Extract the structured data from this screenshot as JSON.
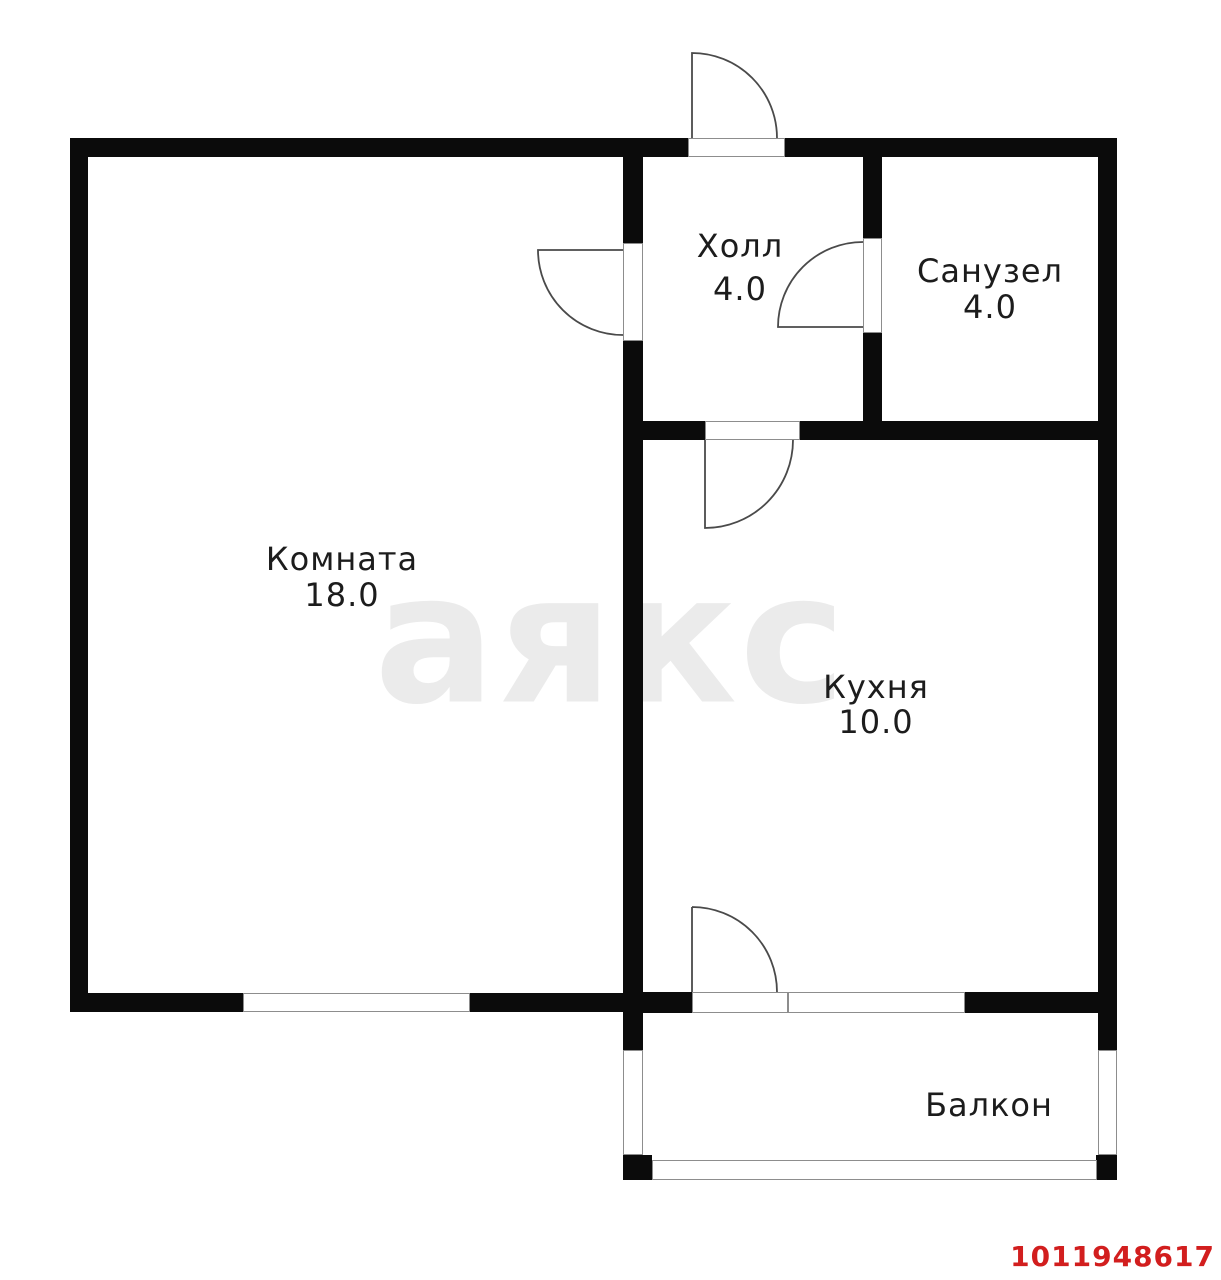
{
  "plan": {
    "watermark": "аякс",
    "listing_id": "1011948617",
    "rooms": {
      "hall": {
        "label": "Холл",
        "area": "4.0"
      },
      "bathroom": {
        "label": "Санузел",
        "area": "4.0"
      },
      "living": {
        "label": "Комната",
        "area": "18.0"
      },
      "kitchen": {
        "label": "Кухня",
        "area": "10.0"
      },
      "balcony": {
        "label": "Балкон"
      }
    },
    "colors": {
      "wall": "#0b0b0b",
      "watermark": "#ebebeb",
      "red": "#d21e1e",
      "door": "#4a4a4a",
      "window": "#8d8d8d"
    }
  }
}
